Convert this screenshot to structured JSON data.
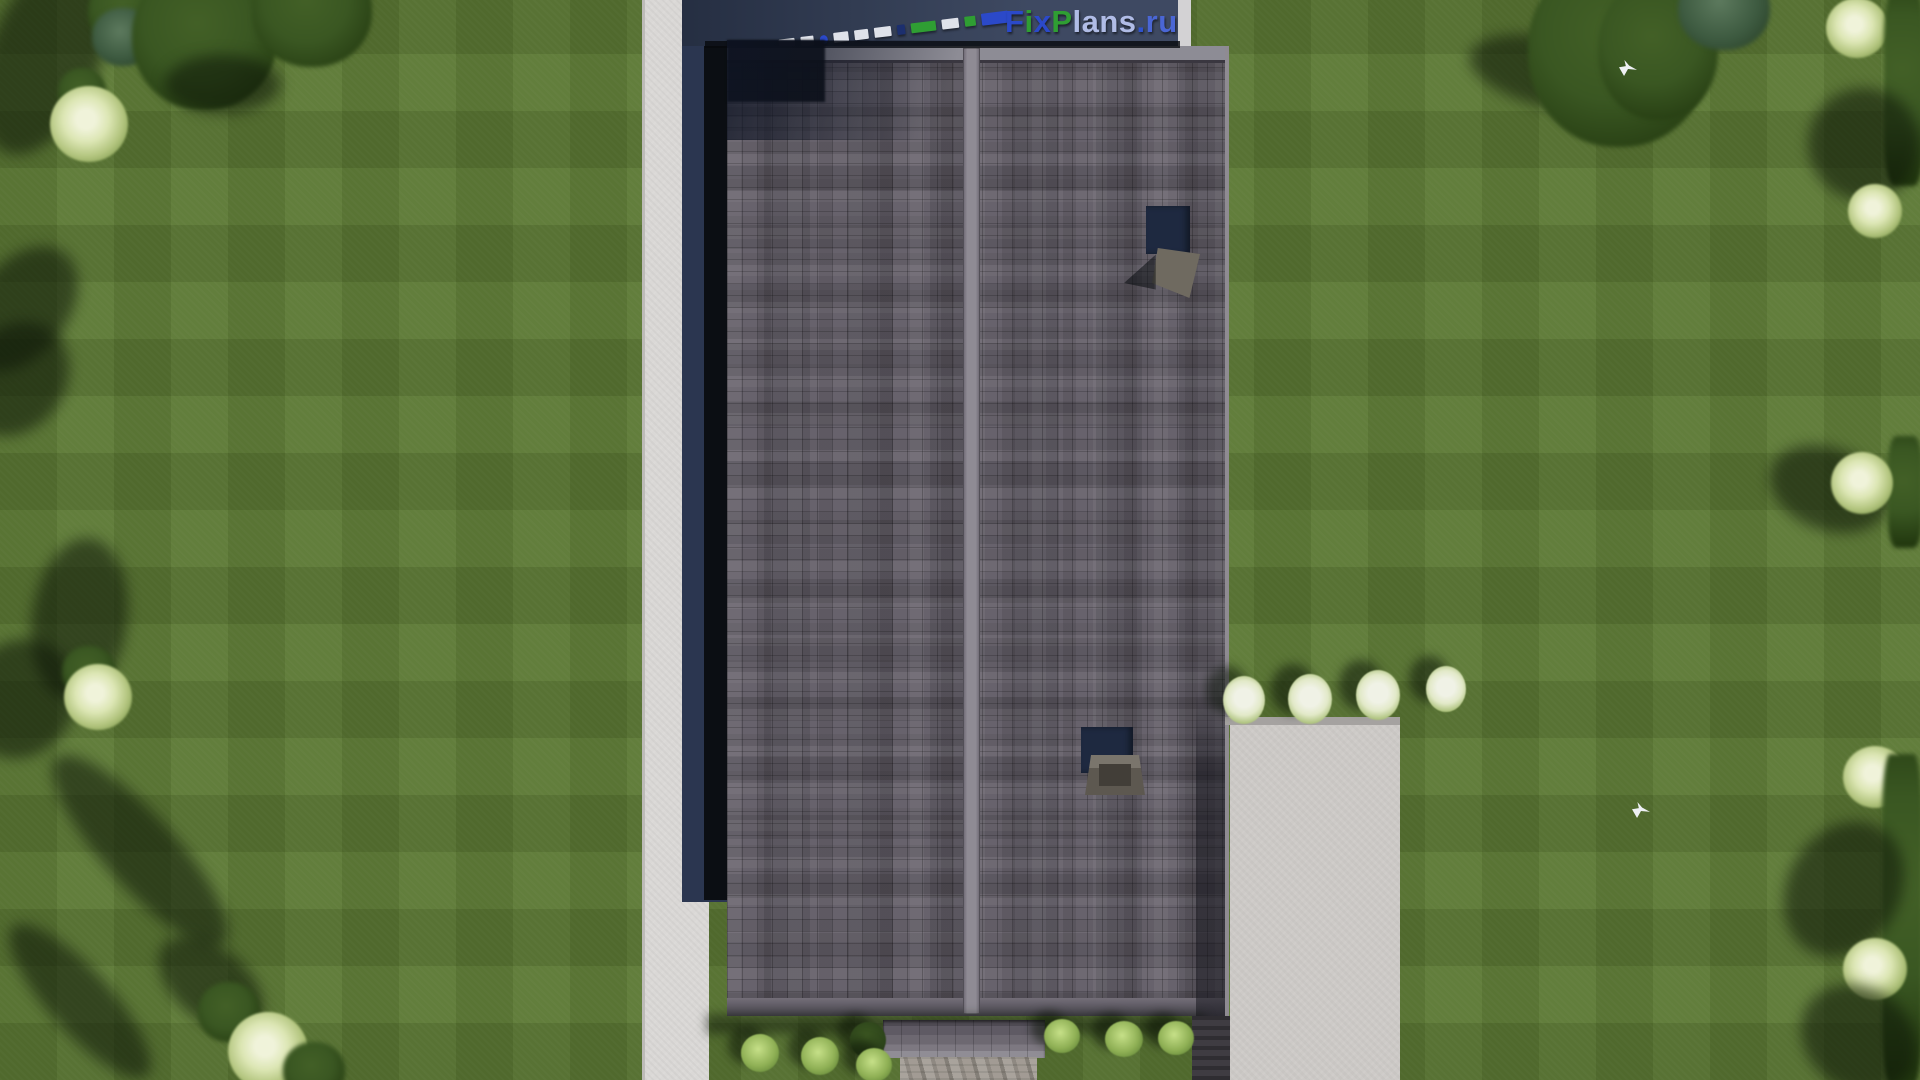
{
  "watermark": {
    "full_text": "FixPlans.ru",
    "segments": [
      {
        "text": "F",
        "color": "#2b49c9"
      },
      {
        "text": "i",
        "color": "#2f9e33"
      },
      {
        "text": "x",
        "color": "#2b49c9"
      },
      {
        "text": "P",
        "color": "#2f9e33"
      },
      {
        "text": "lans",
        "color": "#b0bce6"
      },
      {
        "text": ".",
        "color": "#2e52cc"
      },
      {
        "text": "ru",
        "color": "#4a66d4"
      }
    ]
  },
  "palette": {
    "lawn": "#5b7833",
    "sidewalk": "#dad8d6",
    "terrace_navy": "#323e58",
    "shadow_navy": "#2b3650",
    "gap_black": "#0b0e13",
    "roof_base": "#615c66",
    "roof_ridge": "#8f8b94",
    "roof_fascia": "#8d8c95",
    "patio": "#cdcac7",
    "stone": "#c9c5c0",
    "chimney_navy": "#1e2940",
    "chimney_cap": "#6f6a60",
    "porch_dark": "#4e4a53",
    "porch_light": "#908d95",
    "bush": "#8fb055",
    "bush_dark": "#2c431a",
    "tree": "#35521e",
    "tree_pale": "#dce6b4",
    "flower": "#f0f2e6",
    "bird": "#eef0f4",
    "logo_blue": "#2b49c9",
    "logo_green": "#2f9e33",
    "logo_light": "#b0bce6"
  },
  "scene": {
    "type": "aerial-3d-render",
    "subject": "single-house roof top view with lawn, sidewalk, patio and trees"
  }
}
